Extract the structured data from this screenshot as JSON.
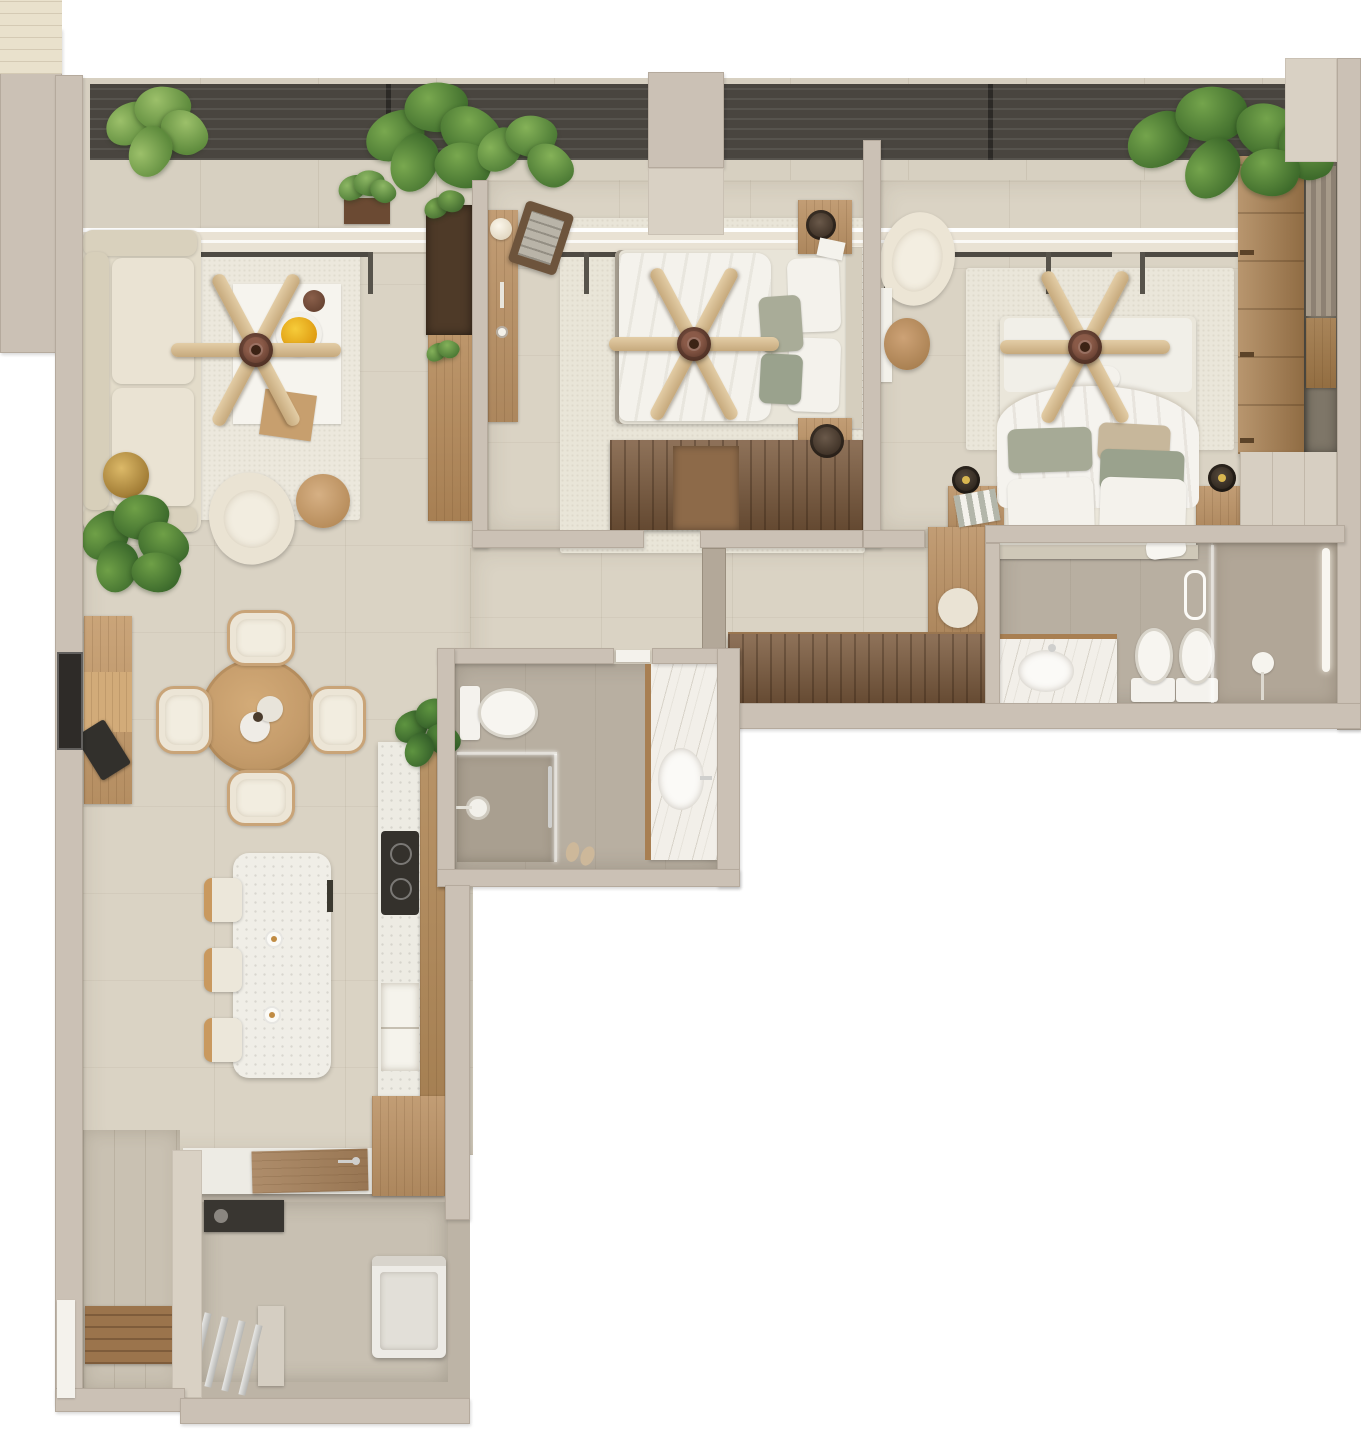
{
  "meta": {
    "type": "3d-rendered-floor-plan",
    "view": "top-down",
    "description": "L-shaped two-bedroom apartment render with balcony, two bathrooms, open living-dining-kitchen and utility room"
  },
  "palette": {
    "background": "#ffffff",
    "wall": "#cbc1b5",
    "wall_light": "#d9d1c4",
    "wall_shadow": "#b3a899",
    "floor_tile": "#dad3c4",
    "bathroom_floor": "#b8afa1",
    "balcony_floor": "#d7d0c1",
    "pergola": "#49453f",
    "rug": "#ece8dd",
    "oak_wood": "#bb9265",
    "walnut_wood": "#7a593c",
    "cream_fabric": "#e6dfcf",
    "duvet_white": "#f4f2ec",
    "pillow_sage": "#a9ac98",
    "pillow_tan": "#c7b79b",
    "fan_blade": "#d6bc93",
    "fan_hub": "#6b4334",
    "marble": "#f2efe9",
    "terrazzo": "#f0eee7",
    "appliance_dark": "#393631",
    "plant_green": "#5d8f43",
    "brass": "#c9a24e",
    "metal": "#cfcfcd"
  },
  "rooms": {
    "balcony": {
      "label": "Balcony terrace",
      "features": [
        "pergola-louvers",
        "potted-plants",
        "sliding-glass-doors"
      ]
    },
    "living": {
      "label": "Living room",
      "features": [
        "sofa",
        "ceiling-fan",
        "area-rug",
        "coffee-table-art-board",
        "fruit-bowl",
        "accent-chair",
        "round-side-table",
        "brass-pouf",
        "monstera-plant",
        "tv-shelf-unit"
      ]
    },
    "dining": {
      "label": "Dining area",
      "features": [
        "round-dining-table",
        "dining-chairs-x4",
        "decor-plates",
        "sideboard",
        "laptop",
        "wall-tv-niche",
        "plant"
      ]
    },
    "kitchen": {
      "label": "Kitchen",
      "features": [
        "terrazzo-island",
        "bar-stools-x3",
        "island-taps",
        "cooktop",
        "sink-niche",
        "tall-cabinets",
        "counter-peninsula",
        "cutting-board",
        "faucet"
      ]
    },
    "bedroom2": {
      "label": "Bedroom 2",
      "features": [
        "double-bed",
        "ceiling-fan",
        "rug",
        "nightstands-x2",
        "speakers",
        "dresser",
        "wall-desk",
        "table-lamp",
        "leaning-art-tray",
        "slatted-headboard"
      ]
    },
    "master": {
      "label": "Master bedroom",
      "features": [
        "double-bed",
        "ceiling-fan",
        "rug",
        "nightstands-x2",
        "black-lamps",
        "picture-frames",
        "armchair",
        "side-table",
        "sliding-door-wardrobe",
        "open-closet",
        "dressing-table",
        "stool"
      ]
    },
    "master_bath": {
      "label": "Master bathroom",
      "features": [
        "marble-vanity",
        "sink",
        "toilet",
        "bidet",
        "glass-shower-partition",
        "towel-rail",
        "floor-lamp",
        "light-strip",
        "towel"
      ]
    },
    "bath2": {
      "label": "Bathroom 2",
      "features": [
        "toilet",
        "marble-vanity",
        "sink",
        "walk-in-shower",
        "glass-partition",
        "shower-head",
        "slippers"
      ]
    },
    "hallway": {
      "label": "Hallway",
      "features": [
        "storage-cabinet"
      ]
    },
    "utility": {
      "label": "Utility laundry room",
      "features": [
        "washing-machine",
        "dark-appliance",
        "drying-rails",
        "laundry-counter",
        "faucet"
      ]
    },
    "entry": {
      "label": "Entry",
      "features": [
        "wood-mat",
        "entry-door"
      ]
    }
  }
}
